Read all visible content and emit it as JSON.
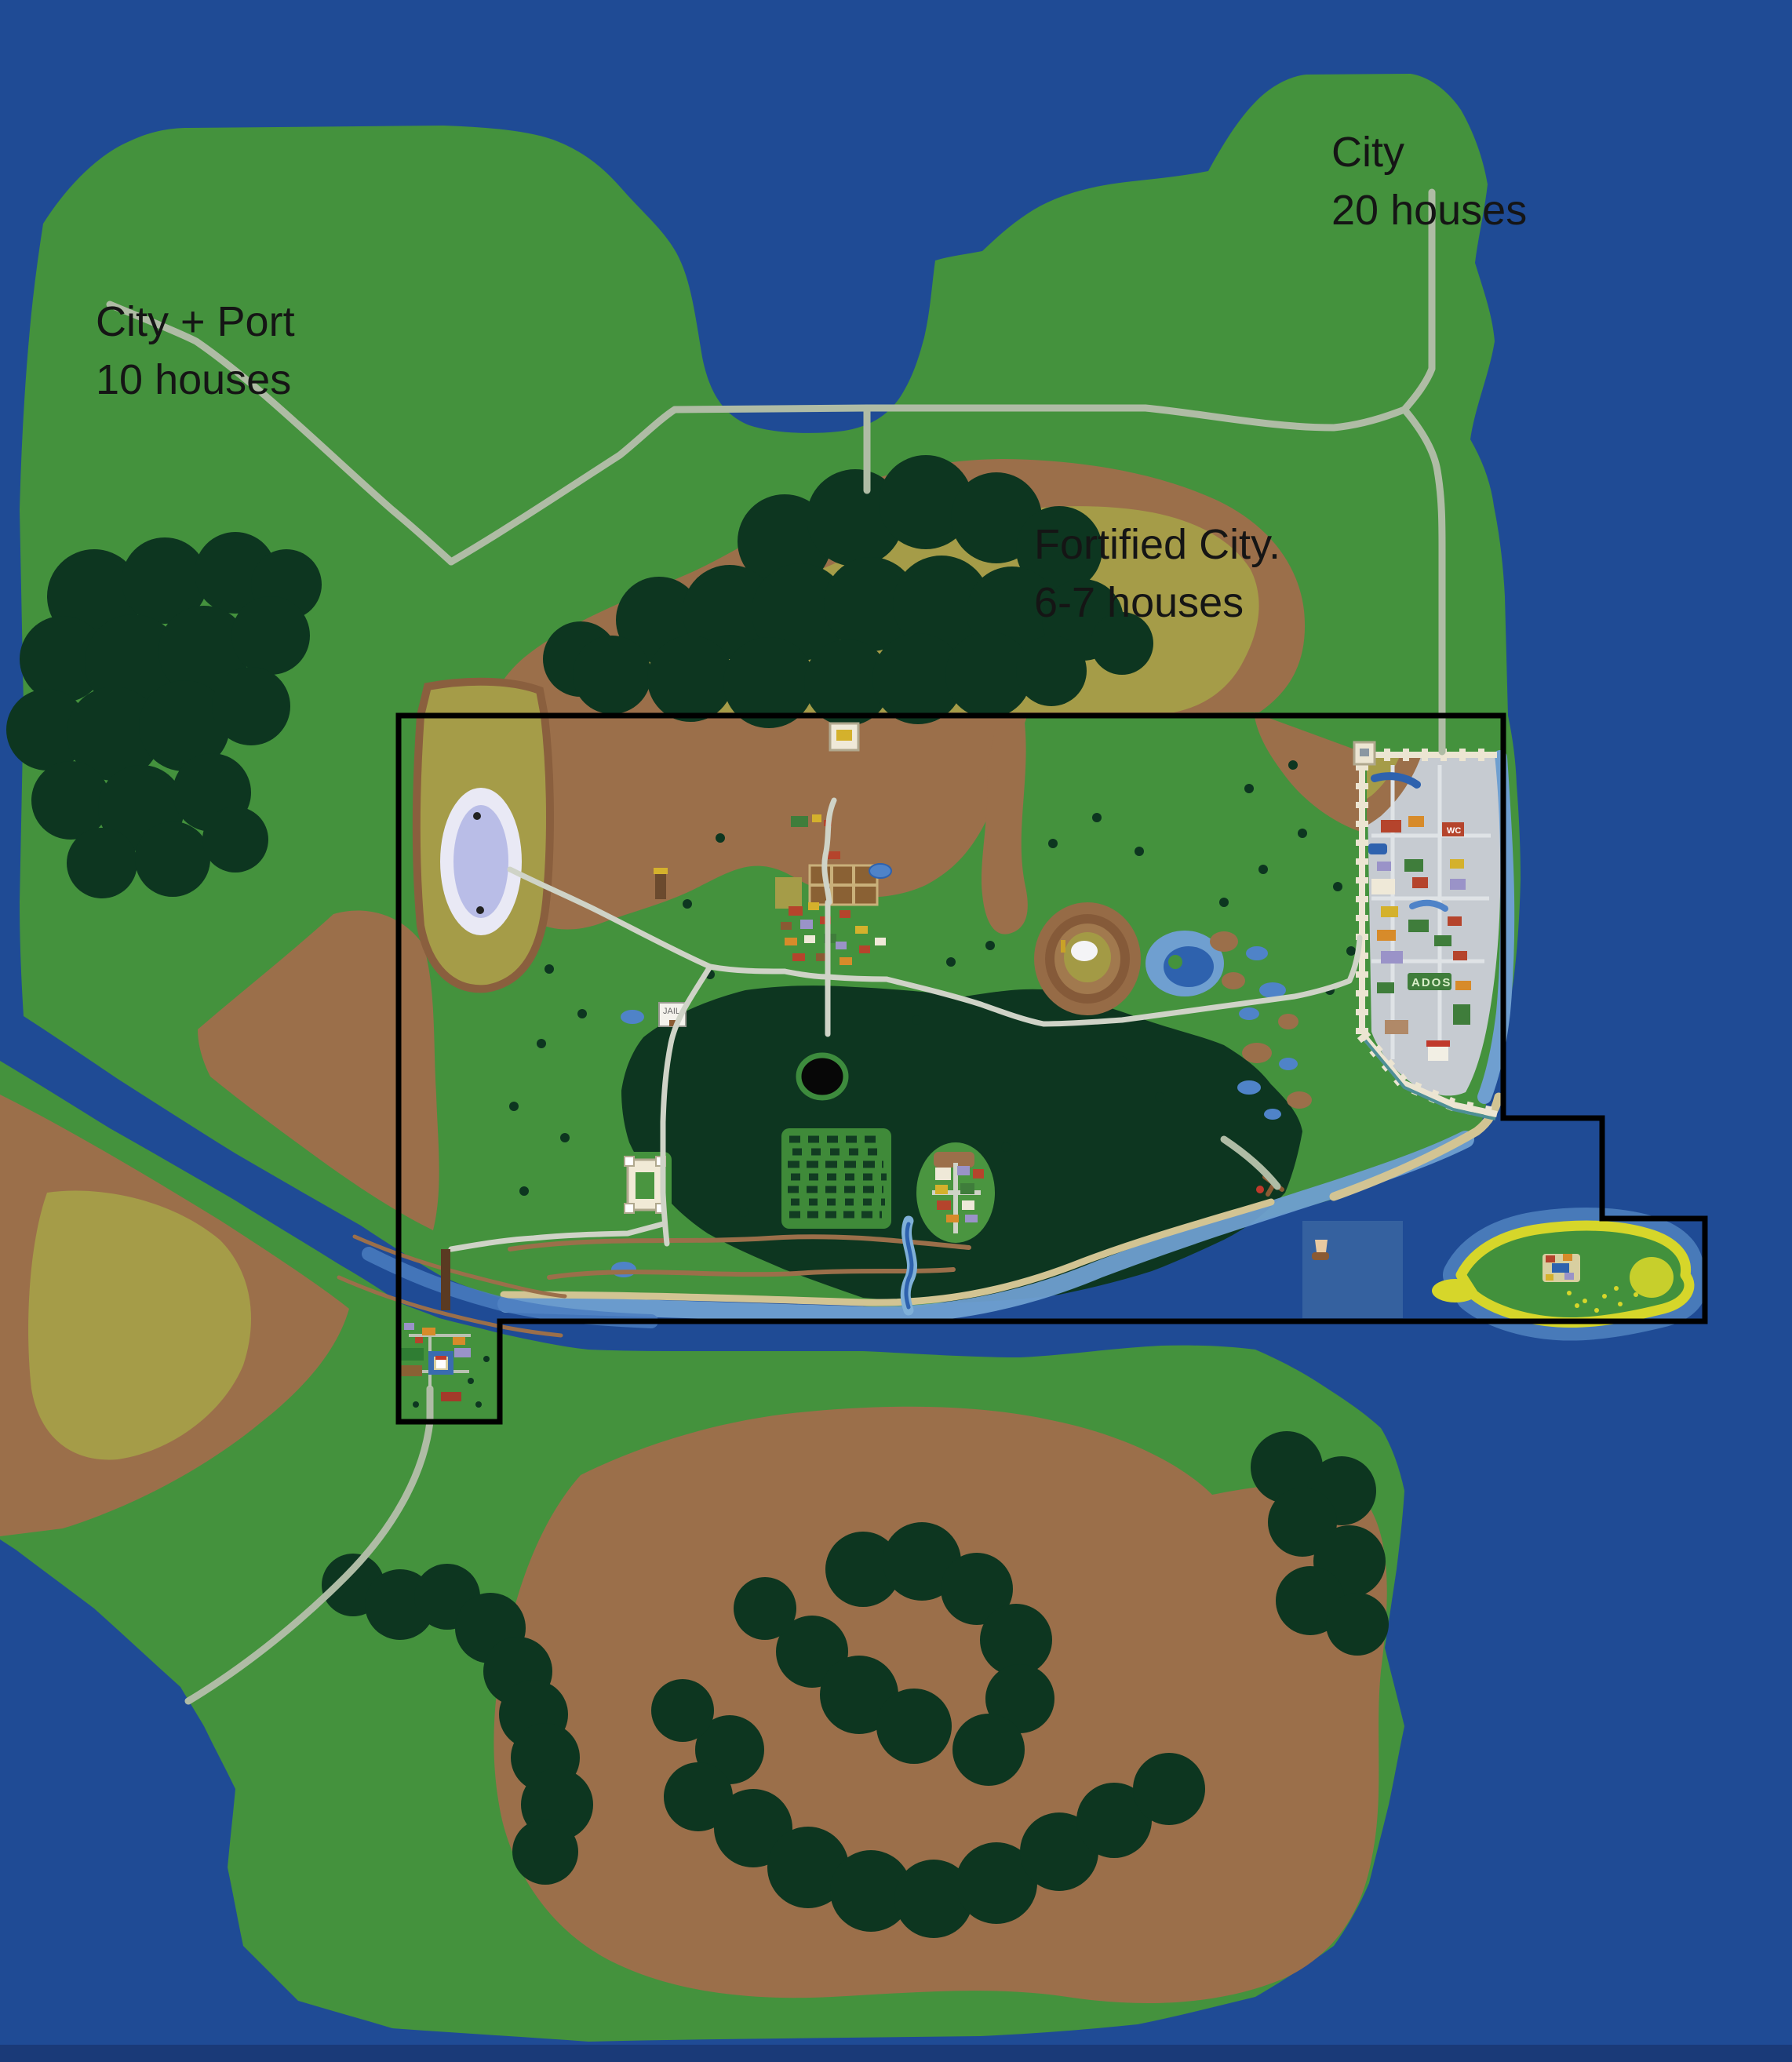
{
  "annotations": {
    "city_ne": {
      "line1": "City",
      "line2": "20 houses"
    },
    "city_port": {
      "line1": "City + Port",
      "line2": "10 houses"
    },
    "fortified_city": {
      "line1": "Fortified City.",
      "line2": "6-7 houses"
    }
  },
  "map_labels": {
    "ados": "ADOS",
    "jail": "JAIL",
    "wc": "WC"
  },
  "colors": {
    "sea": "#1F4B95",
    "sea_deep": "#1A3A78",
    "land": "#44923D",
    "forest": "#0D3620",
    "mountain": "#9B6F4A",
    "plateau": "#A59C48",
    "road": "#AFBCA5",
    "road_inner": "#CFD3C7",
    "shallow": "#6F9FD0",
    "river_mid": "#4A7CC0",
    "lake_rim": "#E9E9F5",
    "lake_core": "#B9BDE7",
    "sand": "#D2C493",
    "island_ring": "#D6D62A",
    "city_ground": "#C6CBD1",
    "city_wall": "#ECE5D2",
    "wall_accent": "#4E8F96",
    "chunk_overlay": "#35619F",
    "highlight_outline": "#000000",
    "label_text": "#151515"
  }
}
